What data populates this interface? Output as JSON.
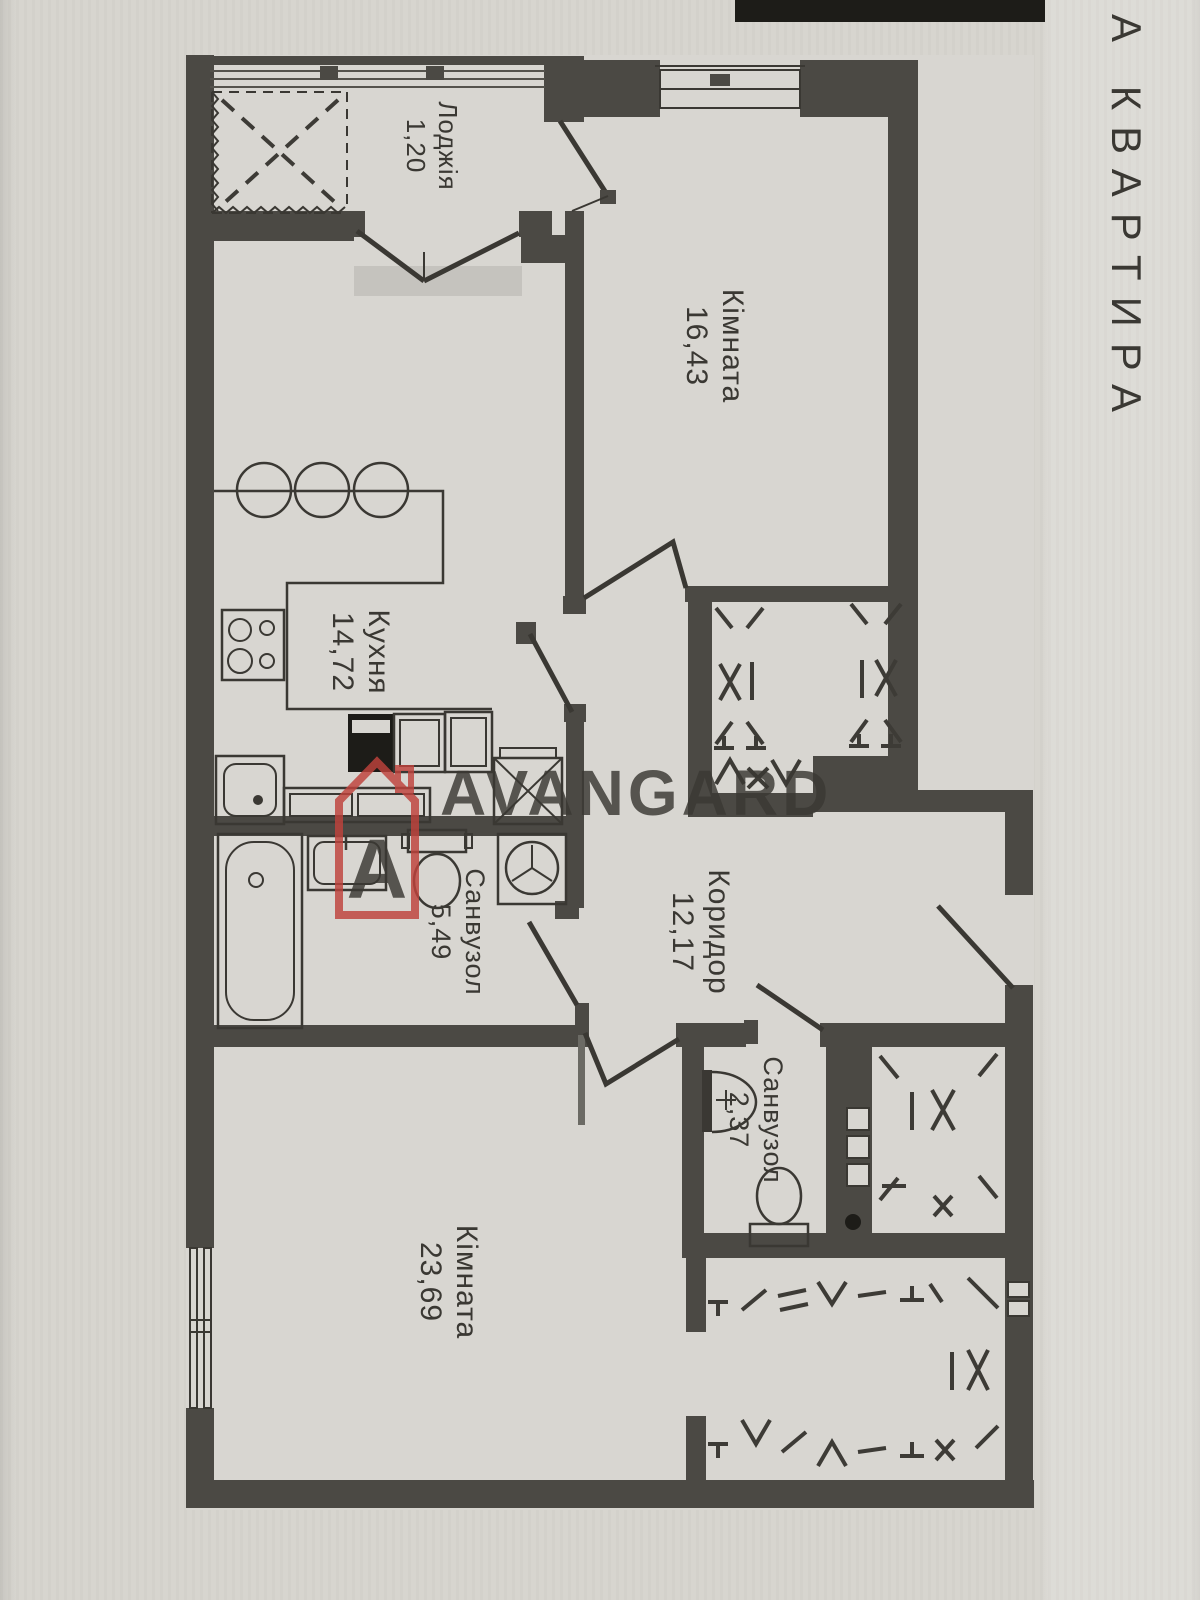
{
  "page": {
    "side_label": "А КВАРТИРА"
  },
  "watermark": {
    "logo_letter": "A",
    "brand": "AVANGARD"
  },
  "rooms": [
    {
      "key": "loggia",
      "name": "Лоджія",
      "area": "1,20"
    },
    {
      "key": "living-room",
      "name": "Кімната",
      "area": "16,43"
    },
    {
      "key": "kitchen",
      "name": "Кухня",
      "area": "14,72"
    },
    {
      "key": "bathroom-main",
      "name": "Санвузол",
      "area": "5,49"
    },
    {
      "key": "corridor",
      "name": "Коридор",
      "area": "12,17"
    },
    {
      "key": "bathroom-small",
      "name": "Санвузол",
      "area": "2,37"
    },
    {
      "key": "bedroom",
      "name": "Кімната",
      "area": "23,69"
    }
  ],
  "colors": {
    "paper": "#d6d4ce",
    "floor": "#d8d6d1",
    "wall": "#4b4944",
    "line": "#3a3833",
    "label": "#3a3833",
    "accent-red": "#bf423c",
    "watermark-text": "#8f99a6",
    "side-text": "#6e6b63"
  }
}
